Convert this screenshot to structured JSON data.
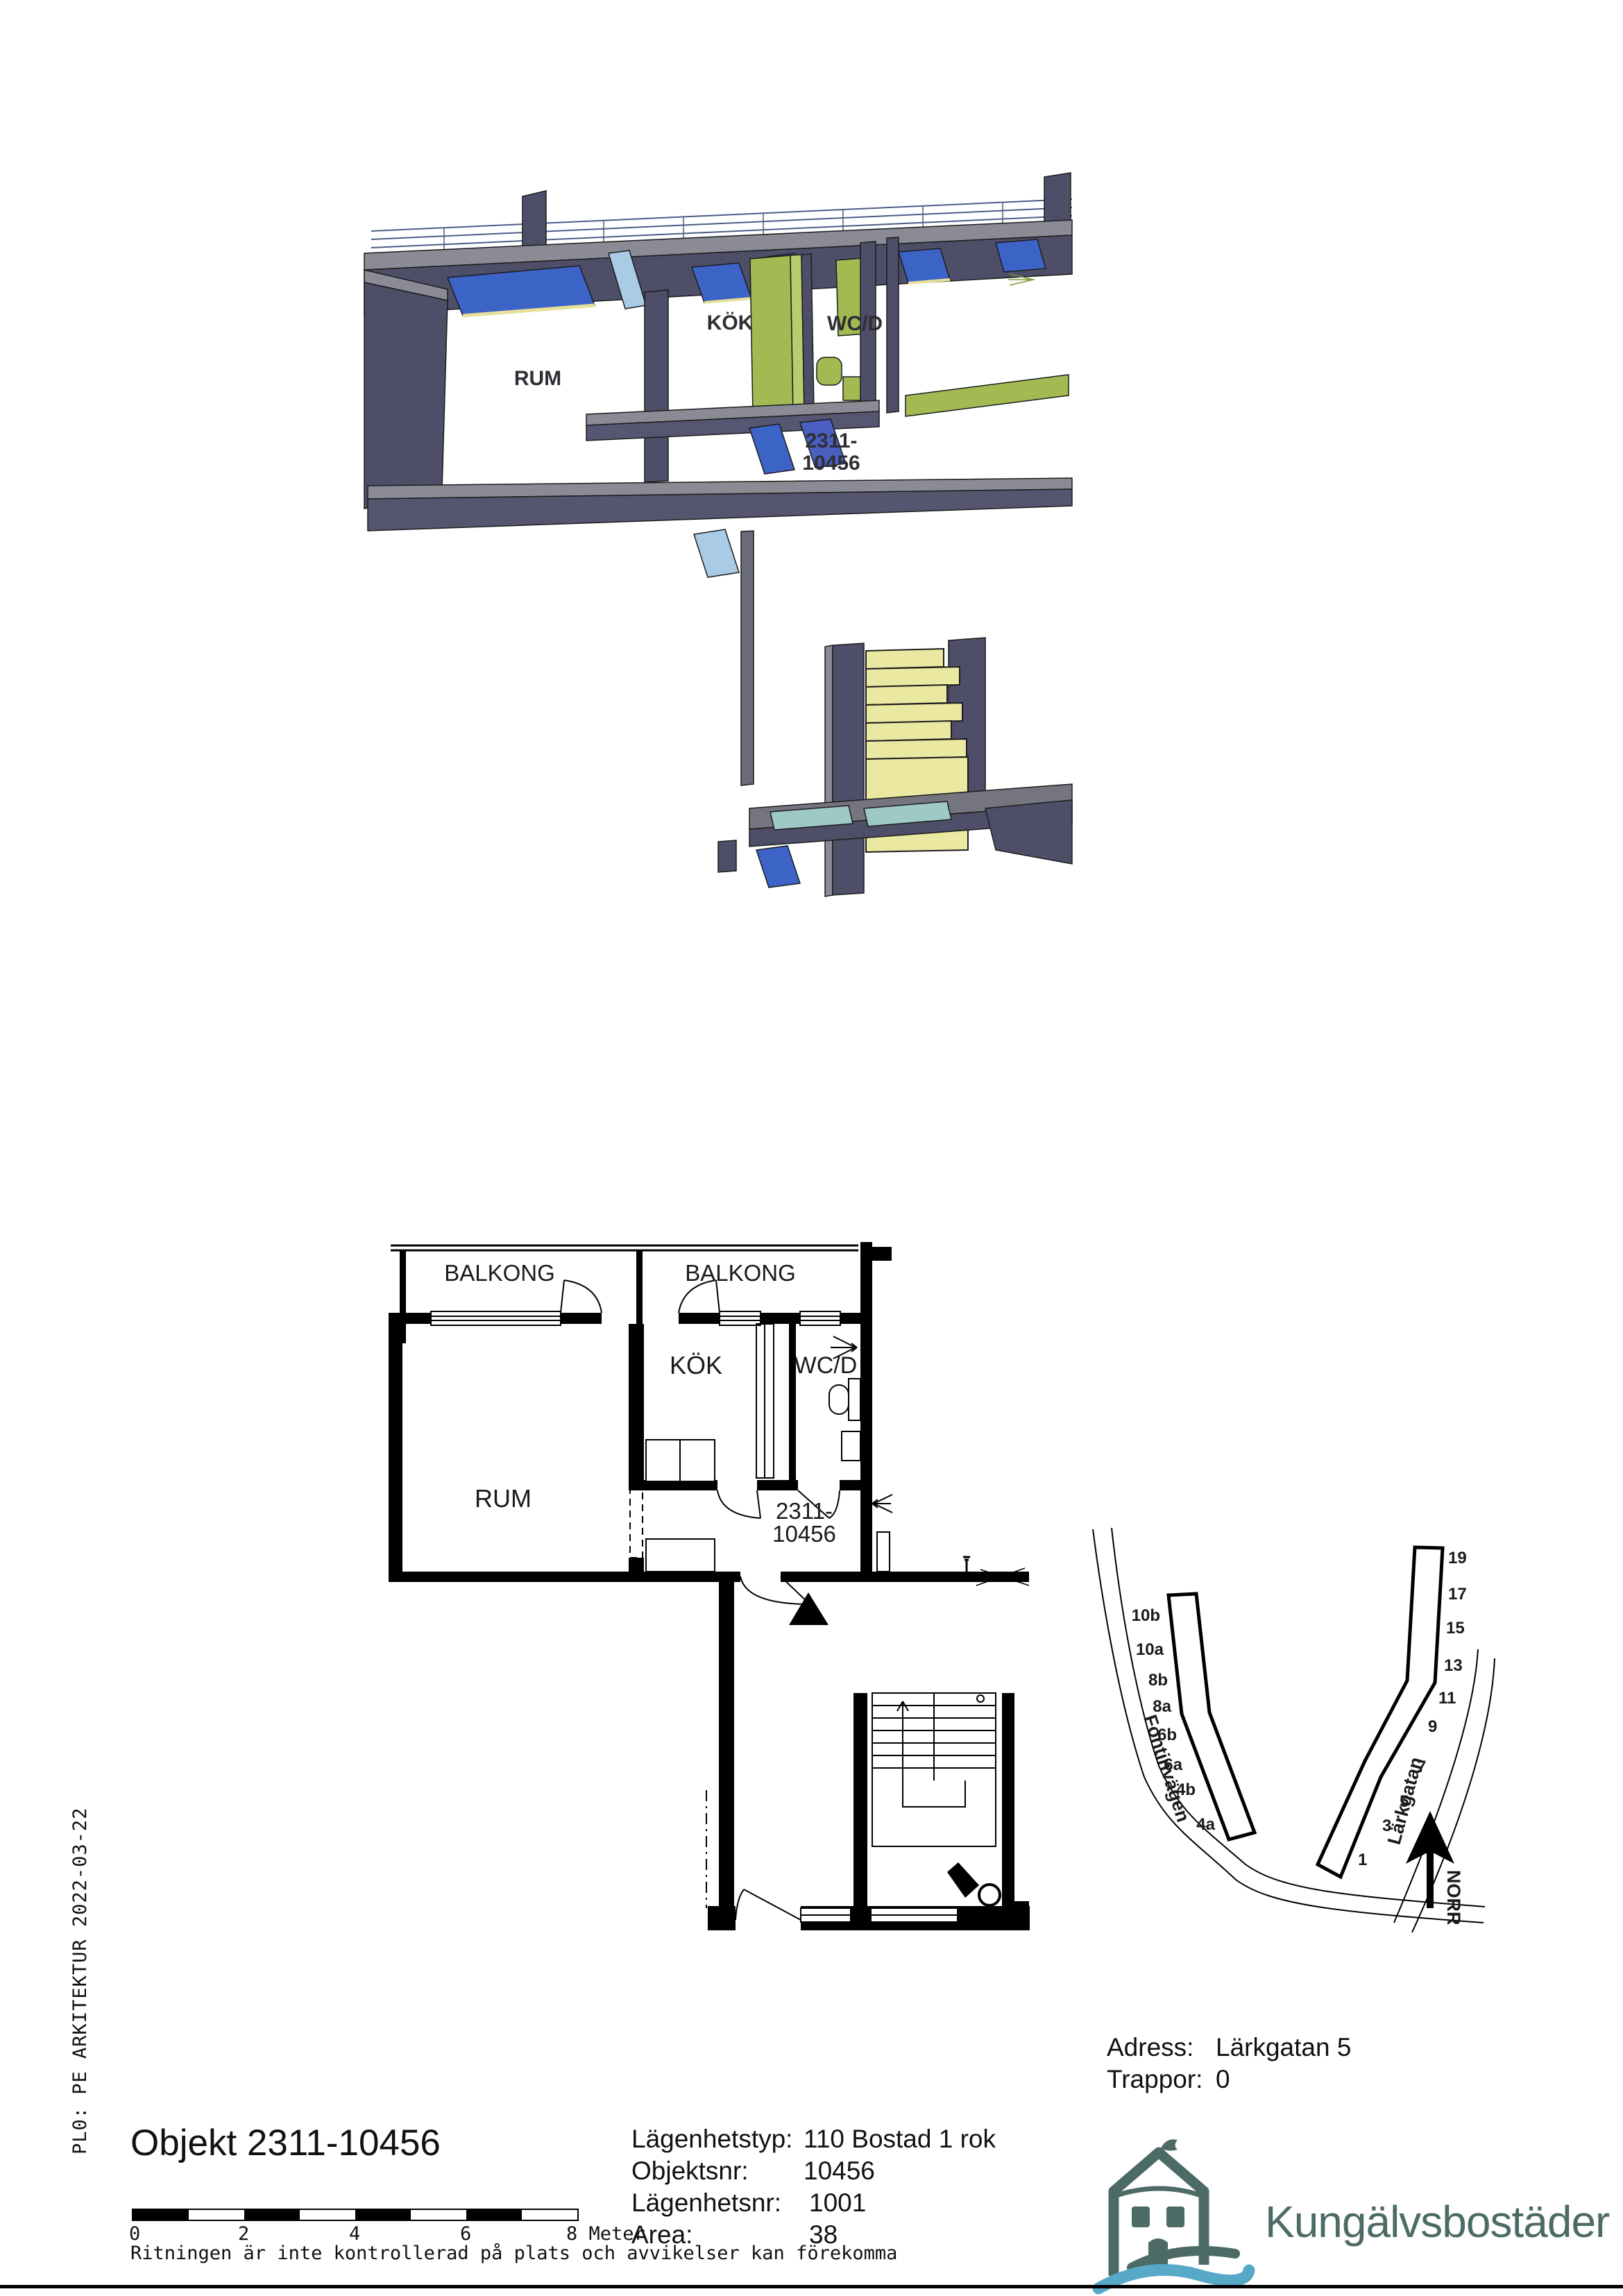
{
  "view3d": {
    "rum": "RUM",
    "kok": "KÖK",
    "wcd": "WC/D",
    "unit1": "2311-",
    "unit2": "10456"
  },
  "plan2d": {
    "balkong_left": "BALKONG",
    "balkong_right": "BALKONG",
    "rum": "RUM",
    "kok": "KÖK",
    "wcd": "WC/D",
    "unit1": "2311-",
    "unit2": "10456"
  },
  "sitemap": {
    "street_left": "Fontinvägen",
    "street_right": "Lärkgatan",
    "north": "NORR",
    "left_entrances": [
      "10b",
      "10a",
      "8b",
      "8a",
      "6b",
      "6a",
      "4b",
      "4a"
    ],
    "right_entrances": [
      "19",
      "17",
      "15",
      "13",
      "11",
      "9",
      "7",
      "5",
      "3",
      "1"
    ]
  },
  "address": {
    "adress_label": "Adress:",
    "adress_value": "Lärkgatan 5",
    "trappor_label": "Trappor:",
    "trappor_value": "0"
  },
  "details": {
    "rows": [
      {
        "label": "Lägenhetstyp:",
        "value": "110 Bostad 1 rok"
      },
      {
        "label": "Objektsnr:",
        "value": "10456"
      },
      {
        "label": "Lägenhetsnr:",
        "value": "1001"
      },
      {
        "label": "Area:",
        "value": "38"
      }
    ]
  },
  "footer": {
    "object_title": "Objekt 2311-10456",
    "plot_stamp": "PL0: PE ARKITEKTUR  2022-03-22",
    "disclaimer": "Ritningen är inte kontrollerad på plats och avvikelser kan förekomma",
    "scale_ticks": [
      "0",
      "2",
      "4",
      "6"
    ],
    "scale_end": "8 Meter"
  },
  "logo": {
    "name": "Kungälvsbostäder"
  },
  "colors": {
    "wall_top": "#8b8b95",
    "wall_dark": "#4e4e69",
    "window_blue": "#3c63c6",
    "window_light": "#aacbe6",
    "furniture_green": "#a3ba52",
    "stair_yellow": "#ebe8a2",
    "floor_teal": "#9ec9c6",
    "brand_dark": "#4d6b66",
    "wave_blue": "#58a8c8"
  }
}
